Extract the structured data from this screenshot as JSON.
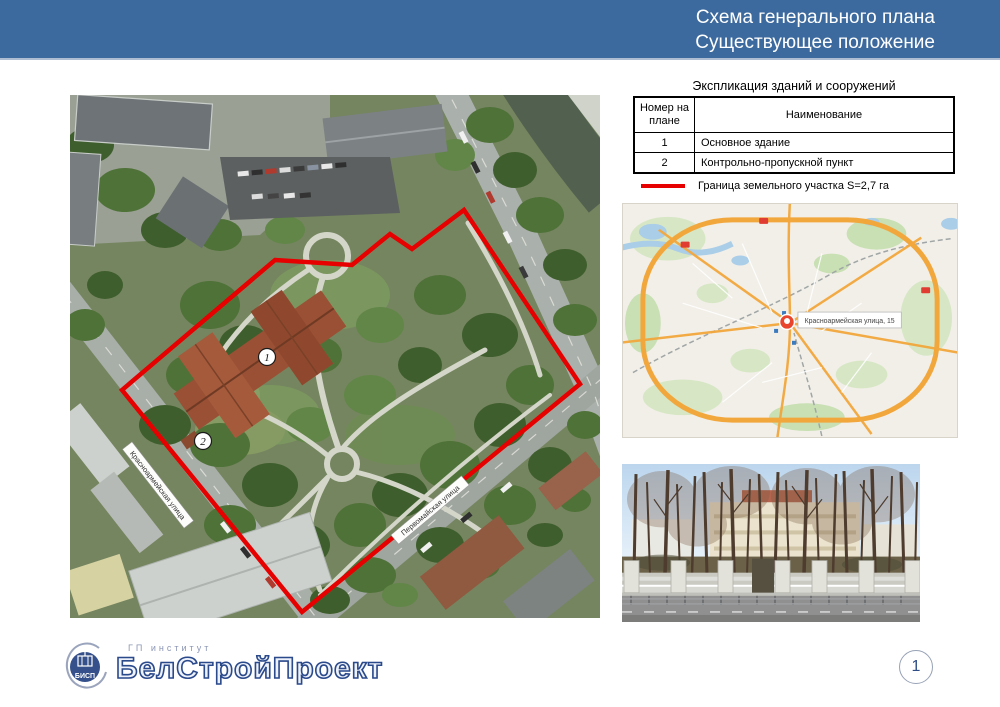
{
  "header": {
    "line1": "Схема генерального плана",
    "line2": "Существующее положение",
    "bg_color": "#3d6a9e"
  },
  "explication": {
    "title": "Экспликация зданий и сооружений",
    "col_number": "Номер на плане",
    "col_name": "Наименование",
    "rows": [
      {
        "num": "1",
        "name": "Основное здание"
      },
      {
        "num": "2",
        "name": "Контрольно-пропускной пункт"
      }
    ]
  },
  "legend": {
    "label": "Граница земельного участка S=2,7 га",
    "line_color": "#e60000"
  },
  "site_plan": {
    "marker_1": "1",
    "marker_2": "2",
    "street_left": "Красноармейская улица",
    "street_bottom": "Первомайская улица",
    "boundary_color": "#e60000"
  },
  "city_map": {
    "marker_label": "Красноармейская улица, 15"
  },
  "logo": {
    "institute": "ГП институт",
    "name": "БелСтройПроект",
    "badge": "БИСП"
  },
  "footer": {
    "page_number": "1"
  }
}
